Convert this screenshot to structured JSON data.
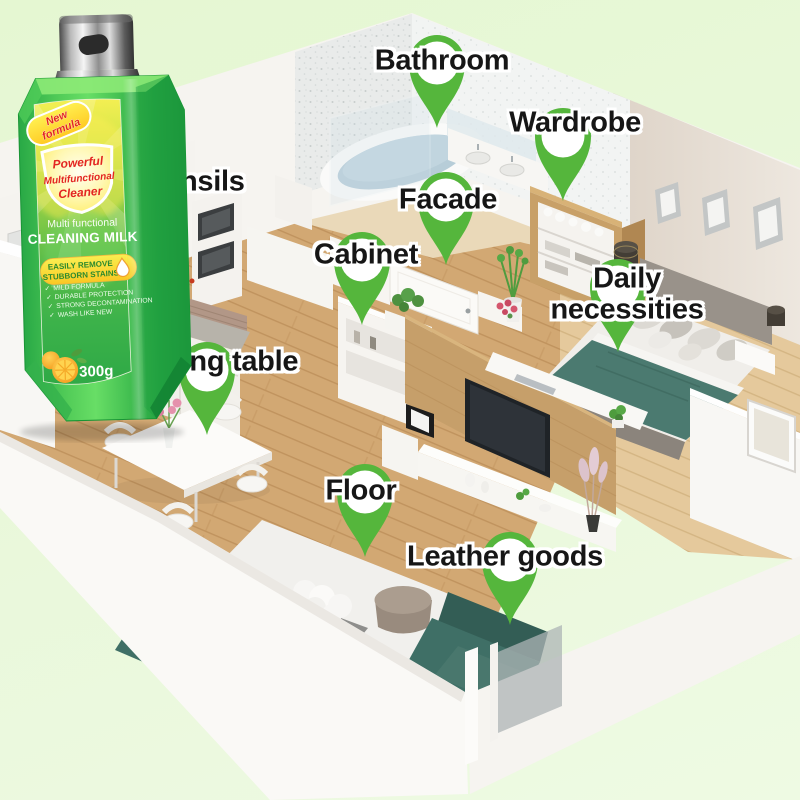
{
  "pins": [
    {
      "id": "bathroom",
      "label": "Bathroom"
    },
    {
      "id": "wardrobe",
      "label": "Wardrobe"
    },
    {
      "id": "kitchen-utensils",
      "label": "Kitchen utensils"
    },
    {
      "id": "facade",
      "label": "Facade"
    },
    {
      "id": "cabinet",
      "label": "Cabinet"
    },
    {
      "id": "daily-necessities",
      "label": "Daily necessities"
    },
    {
      "id": "dining-table",
      "label": "Dining table"
    },
    {
      "id": "floor",
      "label": "Floor"
    },
    {
      "id": "leather-goods",
      "label": "Leather goods"
    }
  ],
  "bottle": {
    "badge_lines": [
      "New",
      "formula"
    ],
    "shield_lines": [
      "Powerful",
      "Multifunctional",
      "Cleaner"
    ],
    "subtitle": "Multi functional",
    "product_name": "CLEANING MILK",
    "pill_lines": [
      "EASILY REMOVE",
      "STUBBORN STAINS"
    ],
    "features": [
      "MILD FORMULA",
      "DURABLE PROTECTION",
      "STRONG DECONTAMINATION",
      "WASH LIKE NEW"
    ],
    "weight": "300g"
  },
  "icons": {
    "check": "✓",
    "pin": "map-marker",
    "droplet": "water-drop",
    "orange": "orange-fruit"
  },
  "colors": {
    "pin_green": "#55b63c",
    "bottle_green": "#3db54b",
    "label_yellow": "#f8ef4e",
    "text_red": "#e32521",
    "pill_yellow": "#ffe93e",
    "background_green": "#e8f8da",
    "sofa_teal": "#3f6f66",
    "wood_floor": "#d2a873"
  }
}
